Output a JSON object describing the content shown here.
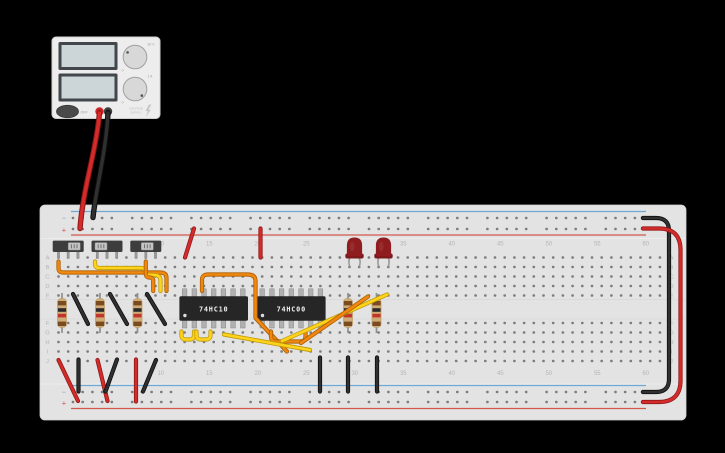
{
  "scene": {
    "background": "#000000",
    "width": 725,
    "height": 453
  },
  "power_supply": {
    "power_button_label": "OFF",
    "brand": [
      "VOLTAGE",
      "SUPPLY"
    ],
    "displays": [
      {
        "name": "voltage-display",
        "value": ""
      },
      {
        "name": "current-display",
        "value": ""
      }
    ],
    "knobs": [
      {
        "name": "voltage-knob",
        "min_label": "0",
        "max_label": "30 V"
      },
      {
        "name": "current-knob",
        "min_label": "0",
        "max_label": "1 A"
      }
    ],
    "terminals": [
      {
        "name": "positive-terminal",
        "color": "#cf2526"
      },
      {
        "name": "negative-terminal",
        "color": "#3c3c3c"
      }
    ]
  },
  "breadboard": {
    "column_numbers": [
      5,
      10,
      15,
      20,
      25,
      30,
      35,
      40,
      45,
      50,
      55,
      60
    ],
    "row_letters_top": [
      "A",
      "B",
      "C",
      "D",
      "E"
    ],
    "row_letters_bottom": [
      "F",
      "G",
      "H",
      "I",
      "J"
    ],
    "rail_negative_label": "−",
    "rail_positive_label": "+",
    "columns": 63,
    "board_color": "#e3e3e3",
    "hole_color": "#7d7d7d",
    "label_color": "#b5b5b5",
    "rail_blue": "#6fa8d2",
    "rail_red": "#d2574d"
  },
  "components": {
    "ics": [
      {
        "label": "74HC10",
        "start_col": 14
      },
      {
        "label": "74HC00",
        "start_col": 22
      }
    ],
    "switches": [
      {
        "name": "slide-switch-1",
        "center_x": 68.2,
        "knob_offset": 6
      },
      {
        "name": "slide-switch-2",
        "center_x": 107,
        "knob_offset": -6
      },
      {
        "name": "slide-switch-3",
        "center_x": 145.8,
        "knob_offset": 1.5
      }
    ],
    "resistors": [
      {
        "x": 62
      },
      {
        "x": 100
      },
      {
        "x": 137.5
      },
      {
        "x": 348
      },
      {
        "x": 376.5
      }
    ],
    "resistor_colors": {
      "body": "#cfac77",
      "bands": [
        "#7a4a21",
        "#2b2b2b",
        "#c2342c",
        "#7a4a21"
      ]
    },
    "leds": [
      {
        "center_x": 354.5,
        "color": "#8f1d1f"
      },
      {
        "center_x": 383.5,
        "color": "#8f1d1f"
      }
    ]
  },
  "wire_colors": {
    "red": [
      "#d42b2b",
      "#911717"
    ],
    "black": [
      "#303030",
      "#0e0e0e"
    ],
    "orange": [
      "#f0870f",
      "#a85e06"
    ],
    "yellow": [
      "#ffd21c",
      "#bd9a08"
    ]
  },
  "wires": [
    {
      "name": "supply-red-lead",
      "color": "red",
      "width": "thick",
      "path": "M99.5,113 C96,152 83,188 80,228.5"
    },
    {
      "name": "supply-black-lead",
      "color": "black",
      "width": "thick",
      "path": "M108,113 C106,152 96,188 93,217.5"
    },
    {
      "name": "jumper-red-plus-to-a14",
      "color": "red",
      "path": "M194,228.5 L185,257.5"
    },
    {
      "name": "jumper-red-plus-to-a21",
      "color": "red",
      "path": "M260.5,228.5 L260.5,257.5"
    },
    {
      "name": "loop-black-right-edge",
      "color": "black",
      "path": "M642.9,218 L656,218 Q669,218 669,231 L669,379 Q669,392 656,392 L642.9,392"
    },
    {
      "name": "loop-red-right-edge",
      "color": "red",
      "path": "M642.9,228.5 L659,228.5 Q680.5,228.5 680.5,250 L680.5,380.5 Q680.5,402 659,402 L642.9,402"
    },
    {
      "name": "jumper-black-e2",
      "color": "black",
      "path": "M73,294 L88,324"
    },
    {
      "name": "jumper-black-e6",
      "color": "black",
      "path": "M110,294 L127,324"
    },
    {
      "name": "jumper-black-e10",
      "color": "black",
      "path": "M147,294 L165,324"
    },
    {
      "name": "jumper-red-j1-plus",
      "color": "red",
      "path": "M58.5,360 L78,401"
    },
    {
      "name": "jumper-black-j3-minus",
      "color": "black",
      "path": "M78.5,359.5 L78.5,391.5"
    },
    {
      "name": "jumper-red-j5-plus",
      "color": "red",
      "path": "M97.5,360 L107.5,401"
    },
    {
      "name": "jumper-black-j7-minus",
      "color": "black",
      "path": "M117,359.5 L105.5,391.5"
    },
    {
      "name": "jumper-red-j9-plus",
      "color": "red",
      "path": "M136,359.5 L136,401.5"
    },
    {
      "name": "jumper-black-j11-minus",
      "color": "black",
      "path": "M156,360 L143,391.5"
    },
    {
      "name": "ground-black-j28",
      "color": "black",
      "path": "M320,357.5 L320,391.5"
    },
    {
      "name": "ground-black-j31",
      "color": "black",
      "path": "M348,357.5 L348,391.5"
    },
    {
      "name": "ground-black-j34",
      "color": "black",
      "path": "M377,357.5 L377,391.5"
    },
    {
      "name": "signal-orange-sw1",
      "color": "orange",
      "path": "M58.5,261.5 L58.5,268 Q58.5,272.5 63,272.5 L160,272.5 Q166.5,272.5 166.5,278 L166.5,291"
    },
    {
      "name": "signal-yellow-sw2",
      "color": "yellow",
      "path": "M95,261.5 L95,264 Q95,268 99.5,268 L140,268 Q145.5,268 145.5,271.5 Q145.5,275 150.5,275 L154,275 Q160.5,275 160.5,280.5 L160.5,291"
    },
    {
      "name": "signal-orange-sw3",
      "color": "orange",
      "path": "M145.8,261.5 L145.8,273.5 Q145.8,277.5 149.5,277.5 Q153.2,277.5 153.2,281 L153.2,291"
    },
    {
      "name": "orange-routed-e16-h24",
      "color": "orange",
      "path": "M202,291 L202,280 Q202,274.5 208,274.5 L247.5,274.5 Q255.5,274.5 255.5,281 L255.5,318 L287,351.5"
    },
    {
      "name": "yellow-u-1",
      "color": "yellow",
      "path": "M181.5,331.5 L181.5,335 Q181.5,339.5 185.5,339.5 L190,339.5 Q194,339.5 194,335 L194,331.5"
    },
    {
      "name": "yellow-u-2",
      "color": "yellow",
      "path": "M196.5,331.5 L196.5,335 Q196.5,339.5 200.5,339.5 L206,339.5 Q210.5,339.5 210.5,335 L210.5,331.5"
    },
    {
      "name": "orange-u-g22-g25",
      "color": "orange",
      "path": "M271,331.5 L271,336.5 Q271,341.5 276,341.5 L300,341.5 Q305.5,341.5 305.5,336.5 L305.5,331.5"
    },
    {
      "name": "yellow-diag-low",
      "color": "yellow",
      "path": "M224,334.5 L310,350"
    },
    {
      "name": "yellow-diag-up",
      "color": "yellow",
      "path": "M282,341 L387,294.5"
    },
    {
      "name": "orange-diag-up",
      "color": "orange",
      "path": "M301,343 L368,296.5"
    }
  ]
}
